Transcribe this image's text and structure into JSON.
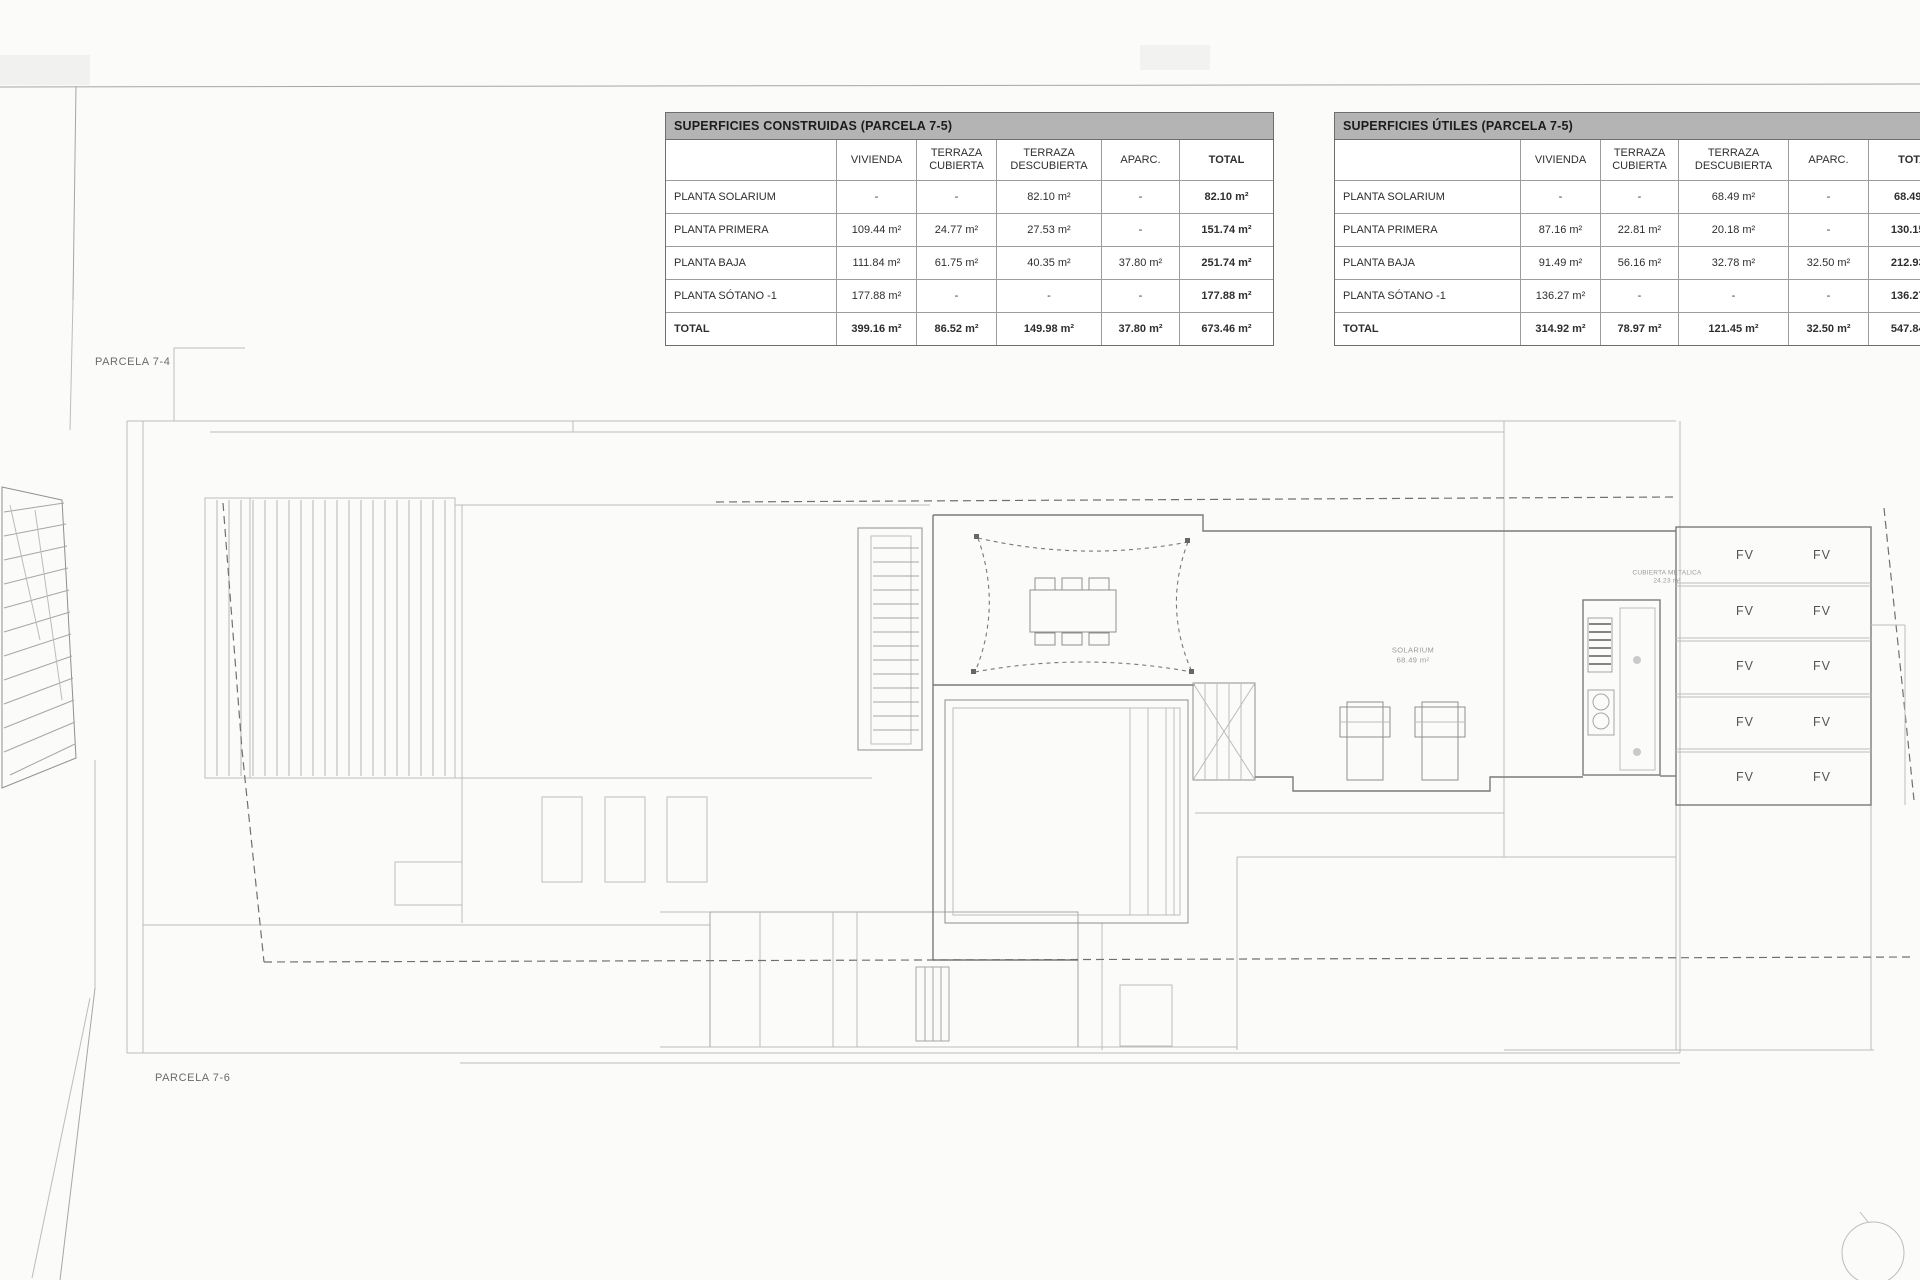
{
  "palette": {
    "paper": "#fbfbfa",
    "table_title_bg": "#b4b4b4",
    "table_border": "#6e6e6e",
    "cell_border": "#9c9c9c",
    "text_dark": "#2e2e2e",
    "plan_line_light": "#bcbcbc",
    "plan_line_dark": "#7b7b7b"
  },
  "plan": {
    "parcela_top": "PARCELA 7-4",
    "parcela_bottom": "PARCELA 7-6",
    "solarium_name": "SOLARIUM",
    "solarium_area": "68.49 m²",
    "cubierta_name": "CUBIERTA METALICA",
    "cubierta_area": "24.23 m²",
    "fv": "FV"
  },
  "tables": [
    {
      "title": "SUPERFICIES CONSTRUIDAS (PARCELA 7-5)",
      "columns": [
        "",
        "VIVIENDA",
        "TERRAZA CUBIERTA",
        "TERRAZA DESCUBIERTA",
        "APARC.",
        "TOTAL"
      ],
      "rows": [
        {
          "label": "PLANTA SOLARIUM",
          "values": [
            "-",
            "-",
            "82.10 m²",
            "-",
            "82.10 m²"
          ]
        },
        {
          "label": "PLANTA PRIMERA",
          "values": [
            "109.44 m²",
            "24.77 m²",
            "27.53 m²",
            "-",
            "151.74 m²"
          ]
        },
        {
          "label": "PLANTA BAJA",
          "values": [
            "111.84 m²",
            "61.75 m²",
            "40.35 m²",
            "37.80 m²",
            "251.74 m²"
          ]
        },
        {
          "label": "PLANTA SÓTANO -1",
          "values": [
            "177.88 m²",
            "-",
            "-",
            "-",
            "177.88 m²"
          ]
        },
        {
          "label": "TOTAL",
          "values": [
            "399.16 m²",
            "86.52 m²",
            "149.98 m²",
            "37.80 m²",
            "673.46 m²"
          ]
        }
      ]
    },
    {
      "title": "SUPERFICIES ÚTILES (PARCELA 7-5)",
      "columns": [
        "",
        "VIVIENDA",
        "TERRAZA CUBIERTA",
        "TERRAZA DESCUBIERTA",
        "APARC.",
        "TOTAL"
      ],
      "rows": [
        {
          "label": "PLANTA SOLARIUM",
          "values": [
            "-",
            "-",
            "68.49 m²",
            "-",
            "68.49 m²"
          ]
        },
        {
          "label": "PLANTA PRIMERA",
          "values": [
            "87.16 m²",
            "22.81 m²",
            "20.18 m²",
            "-",
            "130.15 m²"
          ]
        },
        {
          "label": "PLANTA BAJA",
          "values": [
            "91.49 m²",
            "56.16 m²",
            "32.78 m²",
            "32.50 m²",
            "212.93 m²"
          ]
        },
        {
          "label": "PLANTA SÓTANO -1",
          "values": [
            "136.27 m²",
            "-",
            "-",
            "-",
            "136.27 m²"
          ]
        },
        {
          "label": "TOTAL",
          "values": [
            "314.92 m²",
            "78.97 m²",
            "121.45 m²",
            "32.50 m²",
            "547.84 m²"
          ]
        }
      ]
    }
  ]
}
